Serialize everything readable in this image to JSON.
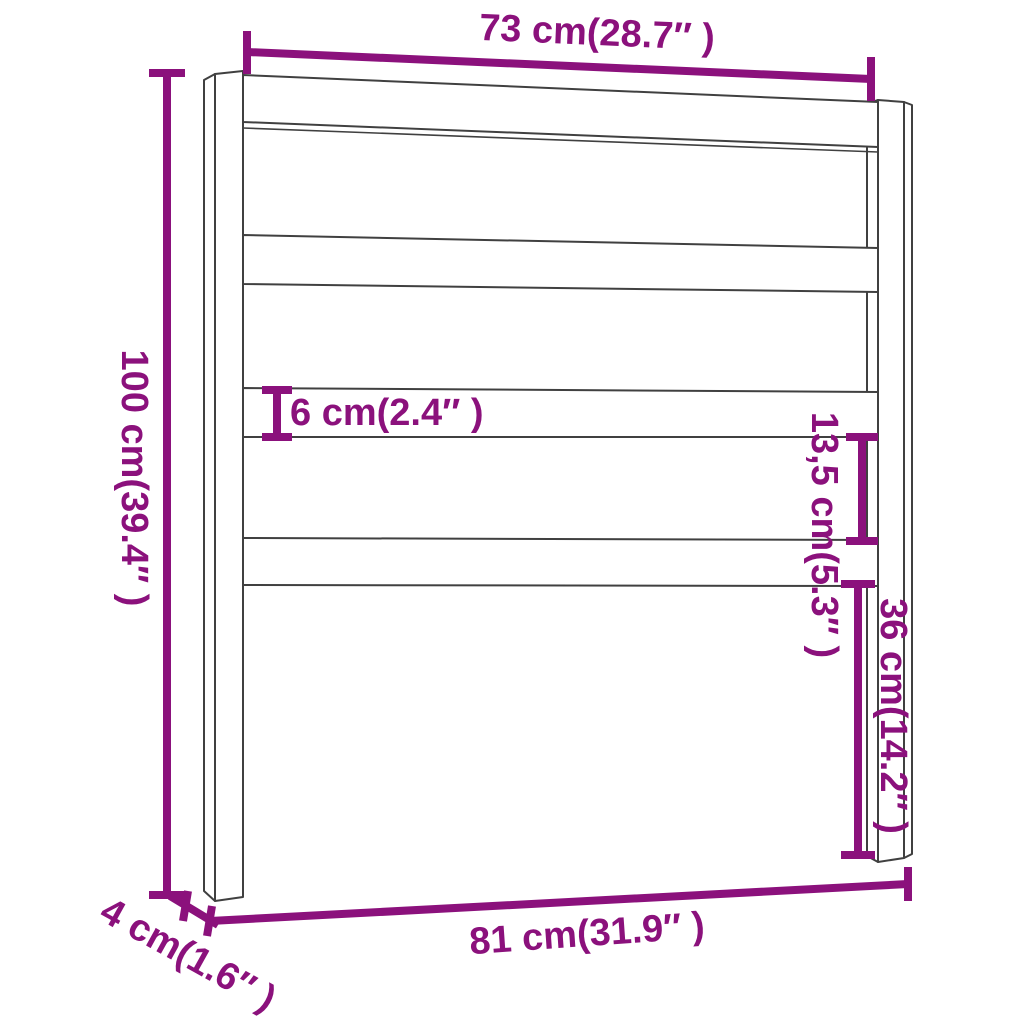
{
  "diagram": {
    "type": "product-dimension-diagram",
    "subject": "bed headboard with two posts and four horizontal slats",
    "colors": {
      "dimension_accent": "#8b117c",
      "outline": "#404040",
      "background": "#ffffff"
    },
    "measurements": {
      "overall_width_top": {
        "label": "73 cm(28.7″ )",
        "value_cm": "73",
        "value_in": "28.7"
      },
      "overall_height": {
        "label": "100 cm(39.4″ )",
        "value_cm": "100",
        "value_in": "39.4"
      },
      "slat_height": {
        "label": "6 cm(2.4″ )",
        "value_cm": "6",
        "value_in": "2.4"
      },
      "slat_gap": {
        "label": "13,5 cm(5.3″ )",
        "value_cm": "13,5",
        "value_in": "5.3"
      },
      "lower_leg_height": {
        "label": "36 cm(14.2″ )",
        "value_cm": "36",
        "value_in": "14.2"
      },
      "overall_width_bottom": {
        "label": "81 cm(31.9″ )",
        "value_cm": "81",
        "value_in": "31.9"
      },
      "leg_depth": {
        "label": "4 cm(1.6″ )",
        "value_cm": "4",
        "value_in": "1.6"
      }
    }
  }
}
